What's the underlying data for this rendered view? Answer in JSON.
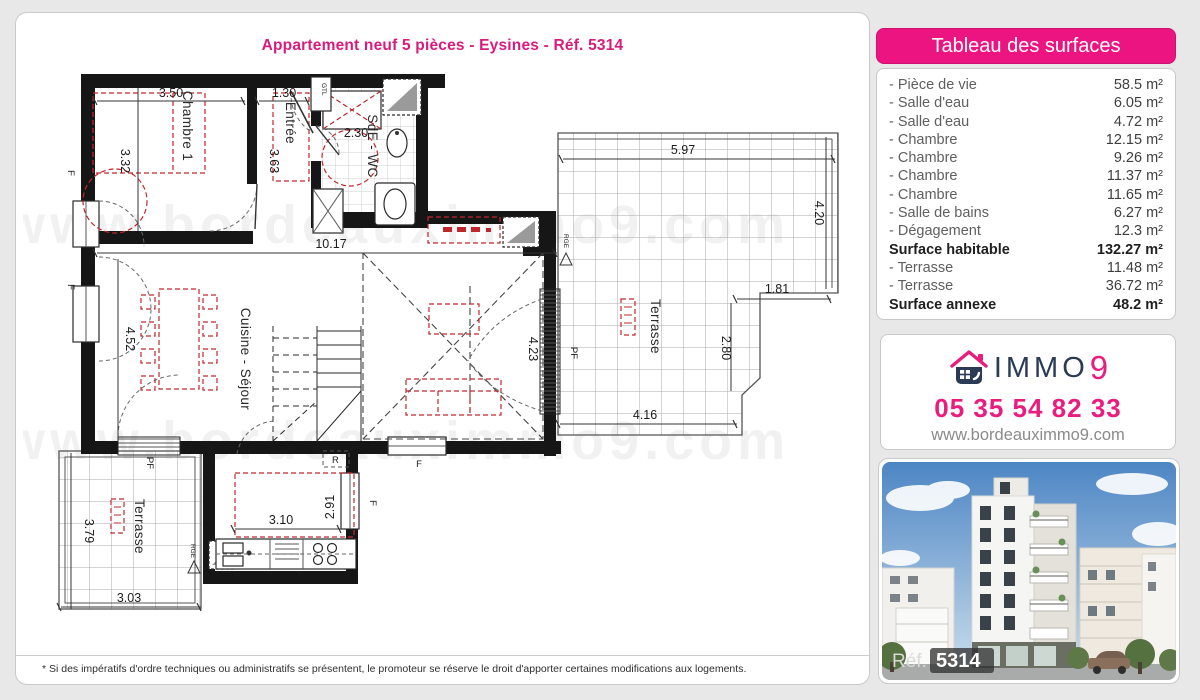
{
  "page": {
    "title": "Appartement neuf 5 pièces - Eysines - Réf. 5314",
    "disclaimer": "* Si des impératifs d'ordre techniques ou administratifs se présentent, le promoteur se réserve le droit d'apporter certaines modifications aux logements.",
    "watermark": "www.bordeauximmo9.com"
  },
  "surfaces": {
    "header": "Tableau des surfaces",
    "rows": [
      {
        "label": "- Pièce de vie",
        "value": "58.5 m²",
        "bold": false
      },
      {
        "label": "- Salle d'eau",
        "value": "6.05 m²",
        "bold": false
      },
      {
        "label": "- Salle d'eau",
        "value": "4.72 m²",
        "bold": false
      },
      {
        "label": "- Chambre",
        "value": "12.15 m²",
        "bold": false
      },
      {
        "label": "- Chambre",
        "value": "9.26 m²",
        "bold": false
      },
      {
        "label": "- Chambre",
        "value": "11.37 m²",
        "bold": false
      },
      {
        "label": "- Chambre",
        "value": "11.65 m²",
        "bold": false
      },
      {
        "label": "- Salle de bains",
        "value": "6.27 m²",
        "bold": false
      },
      {
        "label": "- Dégagement",
        "value": "12.3 m²",
        "bold": false
      },
      {
        "label": "Surface habitable",
        "value": "132.27 m²",
        "bold": true
      },
      {
        "label": "- Terrasse",
        "value": "11.48 m²",
        "bold": false
      },
      {
        "label": "- Terrasse",
        "value": "36.72 m²",
        "bold": false
      },
      {
        "label": "Surface annexe",
        "value": "48.2 m²",
        "bold": true
      }
    ]
  },
  "agency": {
    "brand_immo": "IMMO",
    "brand_nine": "9",
    "phone": "05 35 54 82 33",
    "website": "www.bordeauximmo9.com",
    "pink": "#e81d7e",
    "navy": "#2b3a55"
  },
  "photo": {
    "ref_label": "Réf.",
    "ref_number": "5314"
  },
  "plan": {
    "rooms": {
      "chambre1": "Chambre 1",
      "entree": "Entrée",
      "sde_wc": "SdE - WC",
      "cuisine_sejour": "Cuisine - Séjour",
      "terrasse": "Terrasse",
      "gtl": "GTL",
      "repere_r": "R"
    },
    "openings": {
      "pf": "PF",
      "f": "F",
      "rge": "RGE"
    },
    "dims": {
      "d350": "3.50",
      "d130": "1.30",
      "d332": "3.32",
      "d363": "3.63",
      "d230": "2.30",
      "d1017": "10.17",
      "d452": "4.52",
      "d423": "4.23",
      "d597": "5.97",
      "d420": "4.20",
      "d181": "1.81",
      "d280": "2.80",
      "d416": "4.16",
      "d310": "3.10",
      "d291": "2.91",
      "d303": "3.03",
      "d379": "3.79"
    }
  }
}
